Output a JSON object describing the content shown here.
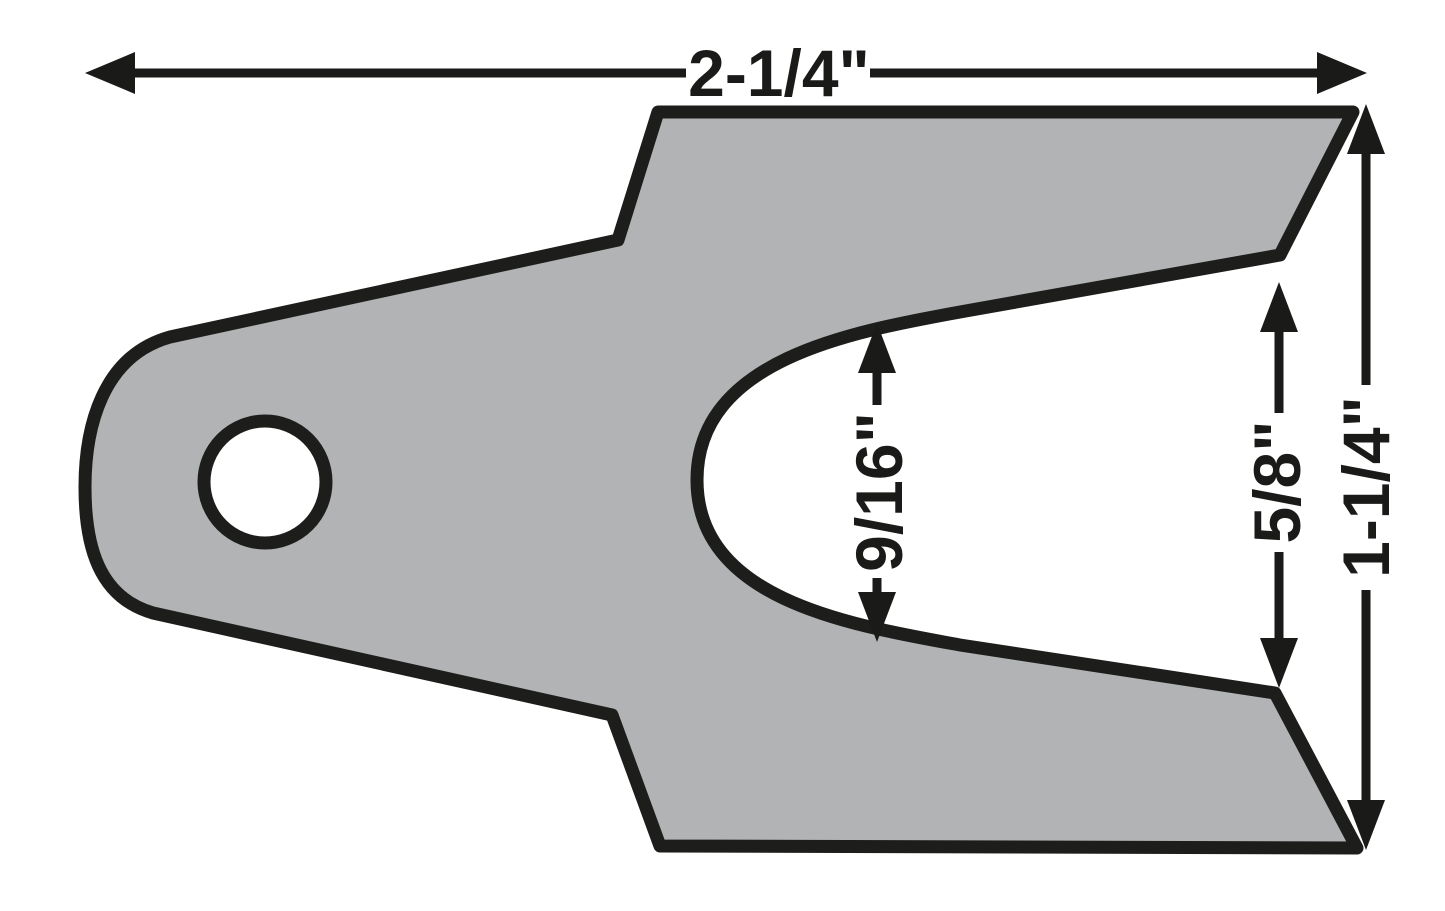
{
  "figure": {
    "title": "Slotted duo-fit shim technical drawing",
    "type": "mechanical-part-dimension-diagram",
    "background_color": "#ffffff",
    "part_fill_color": "#b1b3b5",
    "outline_color": "#1d1d1b",
    "dimension_color": "#1a1a18",
    "dimensions": {
      "overall_width": {
        "label": "2-1/4\"",
        "orientation": "horizontal",
        "position": "top"
      },
      "overall_height": {
        "label": "1-1/4\"",
        "orientation": "vertical",
        "position": "right"
      },
      "slot_opening": {
        "label": "5/8\"",
        "orientation": "vertical",
        "position": "inside-right"
      },
      "slot_mid_width": {
        "label": "9/16\"",
        "orientation": "vertical",
        "position": "inside-slot"
      }
    },
    "features": {
      "mounting_hole": "round hole in left tongue",
      "slot": "U-shaped open slot facing right"
    }
  }
}
